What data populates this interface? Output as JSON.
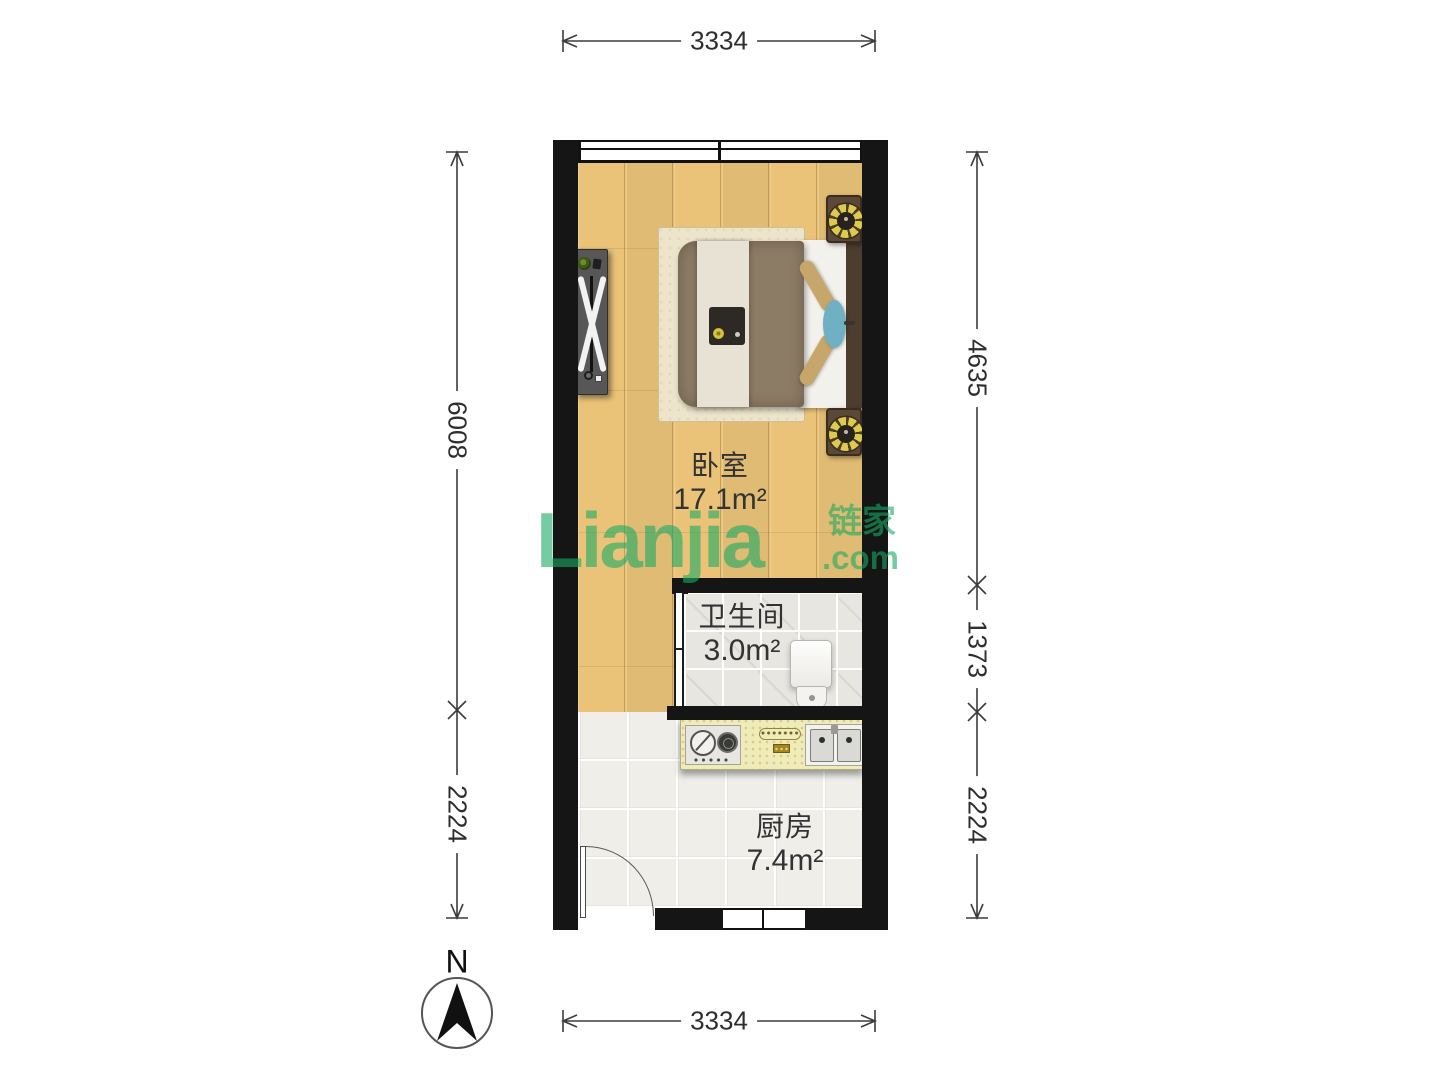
{
  "plan": {
    "rooms": [
      {
        "name": "卧室",
        "area": "17.1m²"
      },
      {
        "name": "卫生间",
        "area": "3.0m²"
      },
      {
        "name": "厨房",
        "area": "7.4m²"
      }
    ]
  },
  "dimensions": {
    "top": "3334",
    "bottom": "3334",
    "left_upper": "6008",
    "left_lower": "2224",
    "right_upper": "4635",
    "right_middle": "1373",
    "right_lower": "2224"
  },
  "watermark": {
    "brand": "Lianjia",
    "brand_cn": "链家",
    "suffix": ".com",
    "color": "#2faa64"
  },
  "compass": {
    "north_label": "N"
  }
}
